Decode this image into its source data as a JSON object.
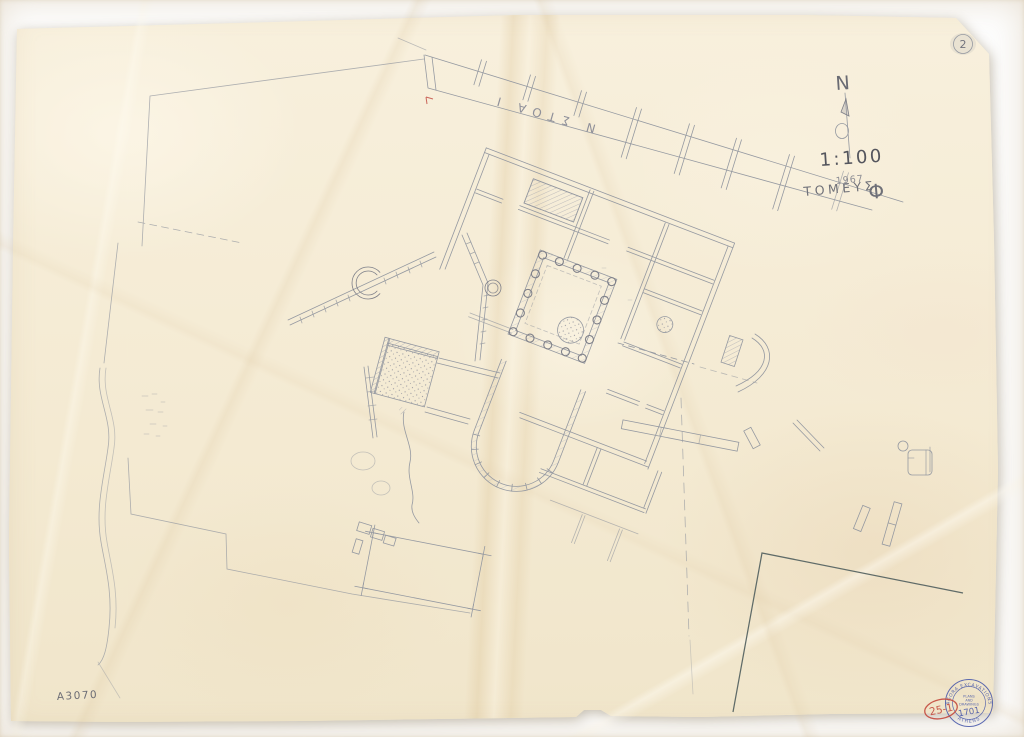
{
  "sheet": {
    "corner_number": "2",
    "north_label": "N",
    "scale_label": "1:100",
    "year_label": "1967",
    "sector_word": "ΤΟΜΕΥΣ",
    "sector_letter": "Φ",
    "stoa_label": "Ν ΣΤΟΑ Ι",
    "inventory_number": "A3070",
    "red_catalog_number": "25-1",
    "stamp": {
      "arc_top": "AGORA EXCAVATIONS",
      "arc_bottom": "ATHENS",
      "center_line1": "PLANS",
      "center_line2": "AND",
      "center_line3": "DRAWINGS",
      "number": "1701"
    },
    "colors": {
      "paper": "#f5ecd5",
      "pencil": "#9599a1",
      "pencil_dark": "#60616a",
      "boundary_dark": "#5f6b68",
      "red_ink": "#c0453c",
      "stamp_blue": "#4253a8"
    }
  }
}
